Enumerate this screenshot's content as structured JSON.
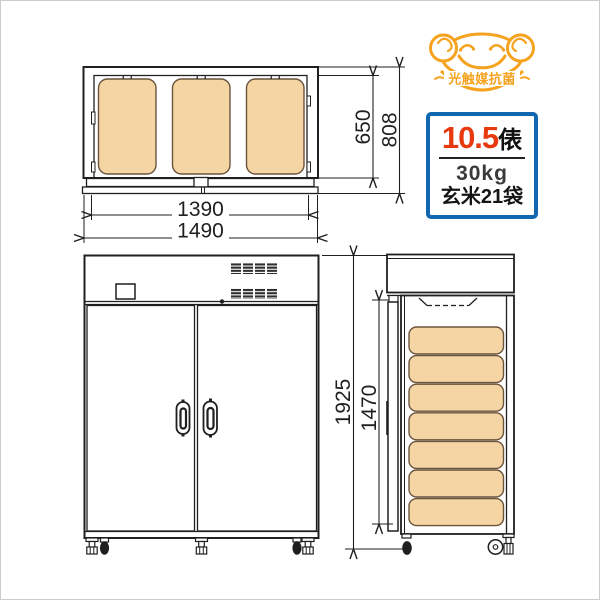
{
  "colors": {
    "line": "#1f1f1f",
    "bag_fill": "#F6D5A4",
    "bag_stroke": "#6B543C",
    "badge_border": "#1168B0",
    "badge_value": "#E8380D",
    "mascot": "#F5A21E",
    "frame": "#cccccc"
  },
  "mascot": {
    "label": "光触媒抗菌"
  },
  "badge": {
    "value": "10.5",
    "unit": "俵",
    "weight": "30kg",
    "bags": "玄米21袋"
  },
  "drawing": {
    "dims": {
      "inner_width": "1390",
      "outer_width": "1490",
      "inner_depth": "650",
      "outer_depth": "808",
      "total_height": "1925",
      "inner_height": "1470"
    },
    "top_view_bag_count": 3,
    "side_view_bag_count": 7
  }
}
